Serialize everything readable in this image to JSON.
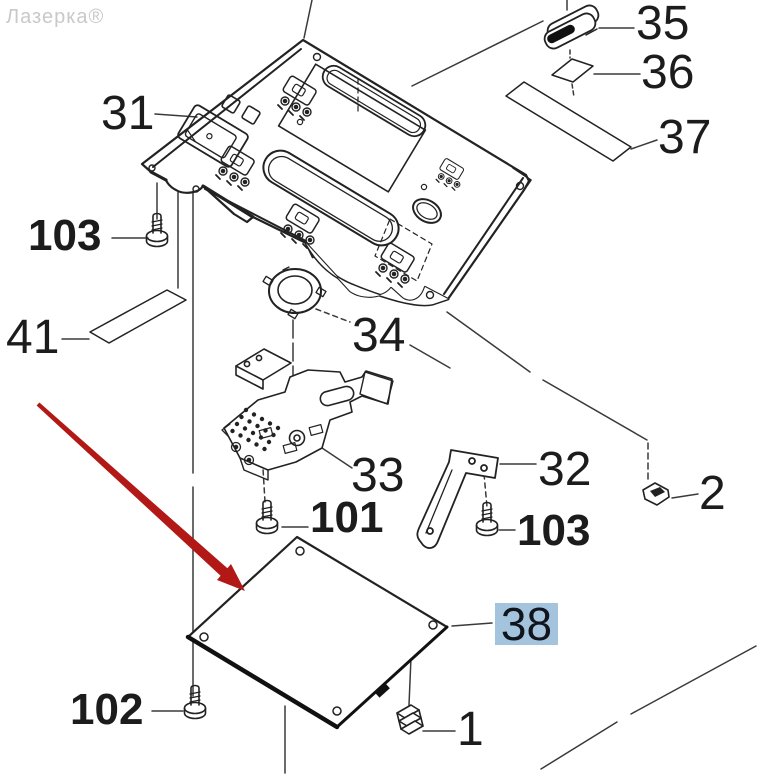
{
  "watermark": {
    "text": "Лазерка®"
  },
  "diagram": {
    "type": "exploded-parts-diagram",
    "subject": "control-panel-assembly",
    "highlighted_part": "38",
    "highlight_color": "#a4c3dc",
    "arrow_color": "#b21815",
    "line_color": "#222222"
  },
  "labels": {
    "part31": "31",
    "part35": "35",
    "part36": "36",
    "part37": "37",
    "part41": "41",
    "part34": "34",
    "part33": "33",
    "part32": "32",
    "part2": "2",
    "part38": "38",
    "part1": "1",
    "screw103_left": "103",
    "screw101": "101",
    "screw103_right": "103",
    "screw102": "102"
  }
}
